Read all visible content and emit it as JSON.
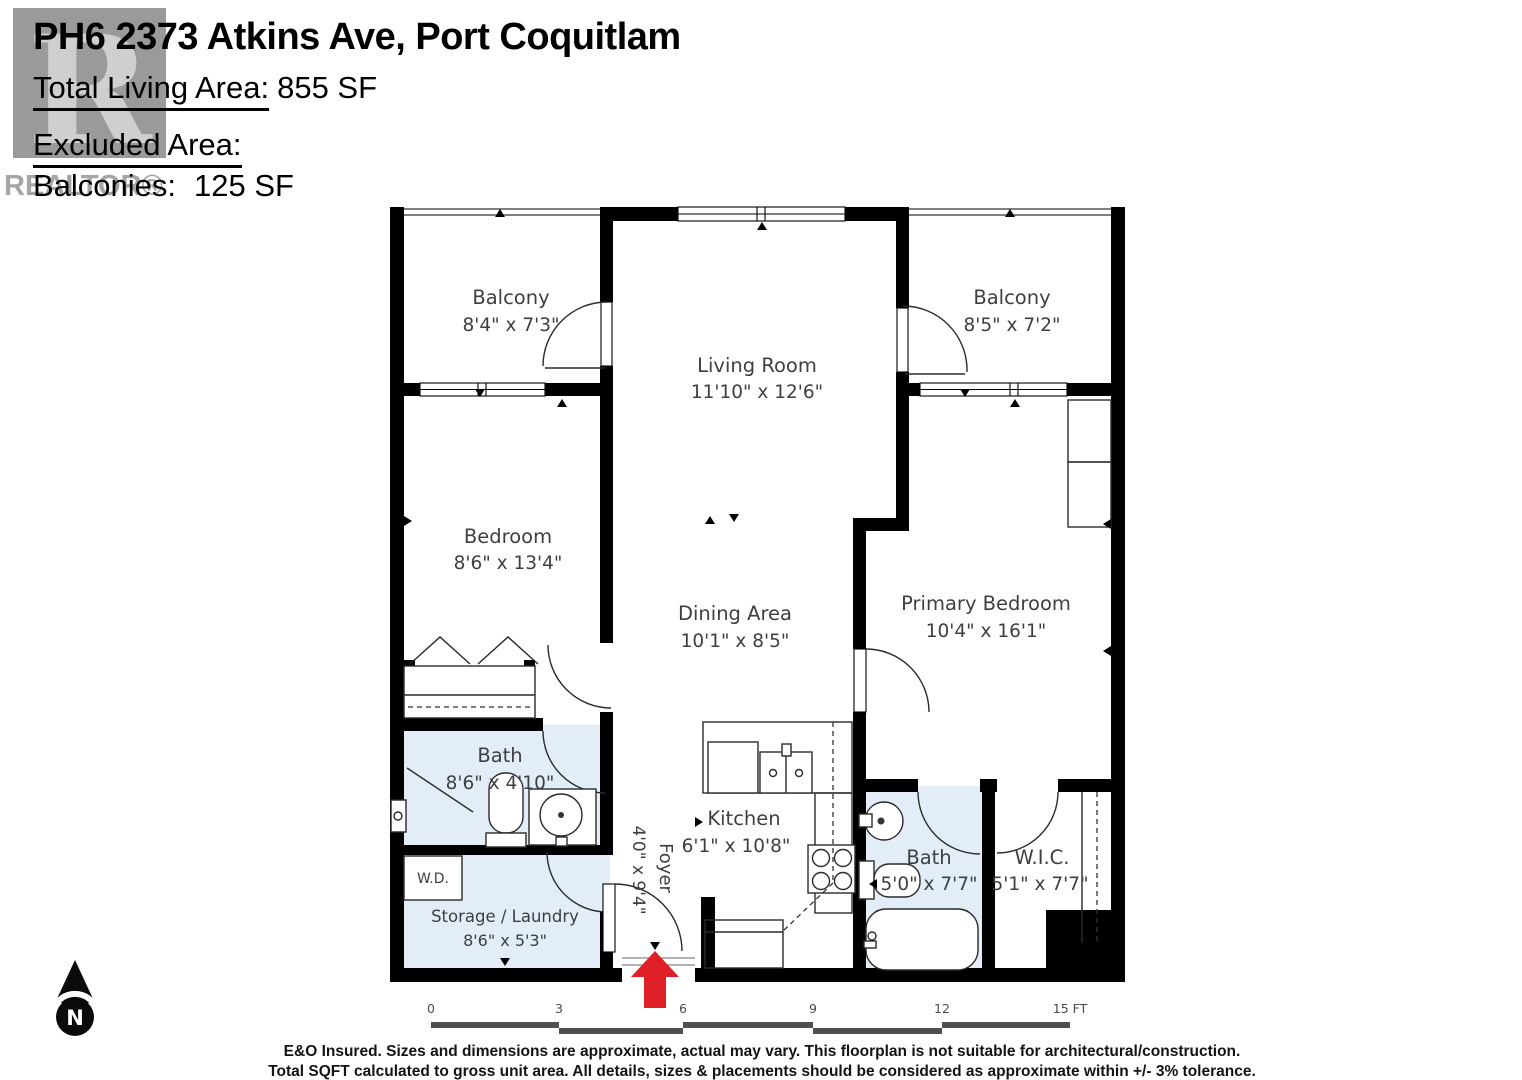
{
  "header": {
    "title": "PH6 2373 Atkins Ave, Port Coquitlam",
    "total_living_area_label": "Total Living Area:",
    "total_living_area_value": "855 SF",
    "excluded_area_label": "Excluded Area:",
    "balconies_label": "Balconies:",
    "balconies_value": "125 SF"
  },
  "watermark": {
    "letter": "R",
    "text": "REALTOR®"
  },
  "rooms": {
    "balcony_left": {
      "name": "Balcony",
      "dims": "8'4\" x 7'3\""
    },
    "living_room": {
      "name": "Living Room",
      "dims": "11'10\" x 12'6\""
    },
    "balcony_right": {
      "name": "Balcony",
      "dims": "8'5\" x 7'2\""
    },
    "bedroom": {
      "name": "Bedroom",
      "dims": "8'6\" x 13'4\""
    },
    "dining_area": {
      "name": "Dining Area",
      "dims": "10'1\" x 8'5\""
    },
    "primary_bedroom": {
      "name": "Primary Bedroom",
      "dims": "10'4\" x 16'1\""
    },
    "bath_main": {
      "name": "Bath",
      "dims": "8'6\" x 4'10\""
    },
    "wd": {
      "name": "W.D."
    },
    "storage_laundry": {
      "name": "Storage / Laundry",
      "dims": "8'6\" x 5'3\""
    },
    "foyer": {
      "name": "Foyer",
      "dims": "4'0\" x 9'4\""
    },
    "kitchen": {
      "name": "Kitchen",
      "dims": "6'1\" x 10'8\""
    },
    "bath_ensuite": {
      "name": "Bath",
      "dims": "5'0\" x 7'7\""
    },
    "wic": {
      "name": "W.I.C.",
      "dims": "5'1\" x 7'7\""
    }
  },
  "compass": {
    "label": "N"
  },
  "scale_bar": {
    "ticks": [
      "0",
      "3",
      "6",
      "9",
      "12",
      "15 FT"
    ]
  },
  "disclaimer": {
    "line1": "E&O Insured. Sizes and dimensions are approximate, actual may vary. This floorplan is not suitable for architectural/construction.",
    "line2": "Total SQFT calculated to gross unit area. All details, sizes & placements should be considered as approximate within +/- 3% tolerance."
  },
  "colors": {
    "wall": "#000000",
    "bath_fill": "#e2edf8",
    "entry_arrow": "#df2127",
    "label_text": "#3d4043",
    "watermark_gray": "#9a9a9a"
  }
}
